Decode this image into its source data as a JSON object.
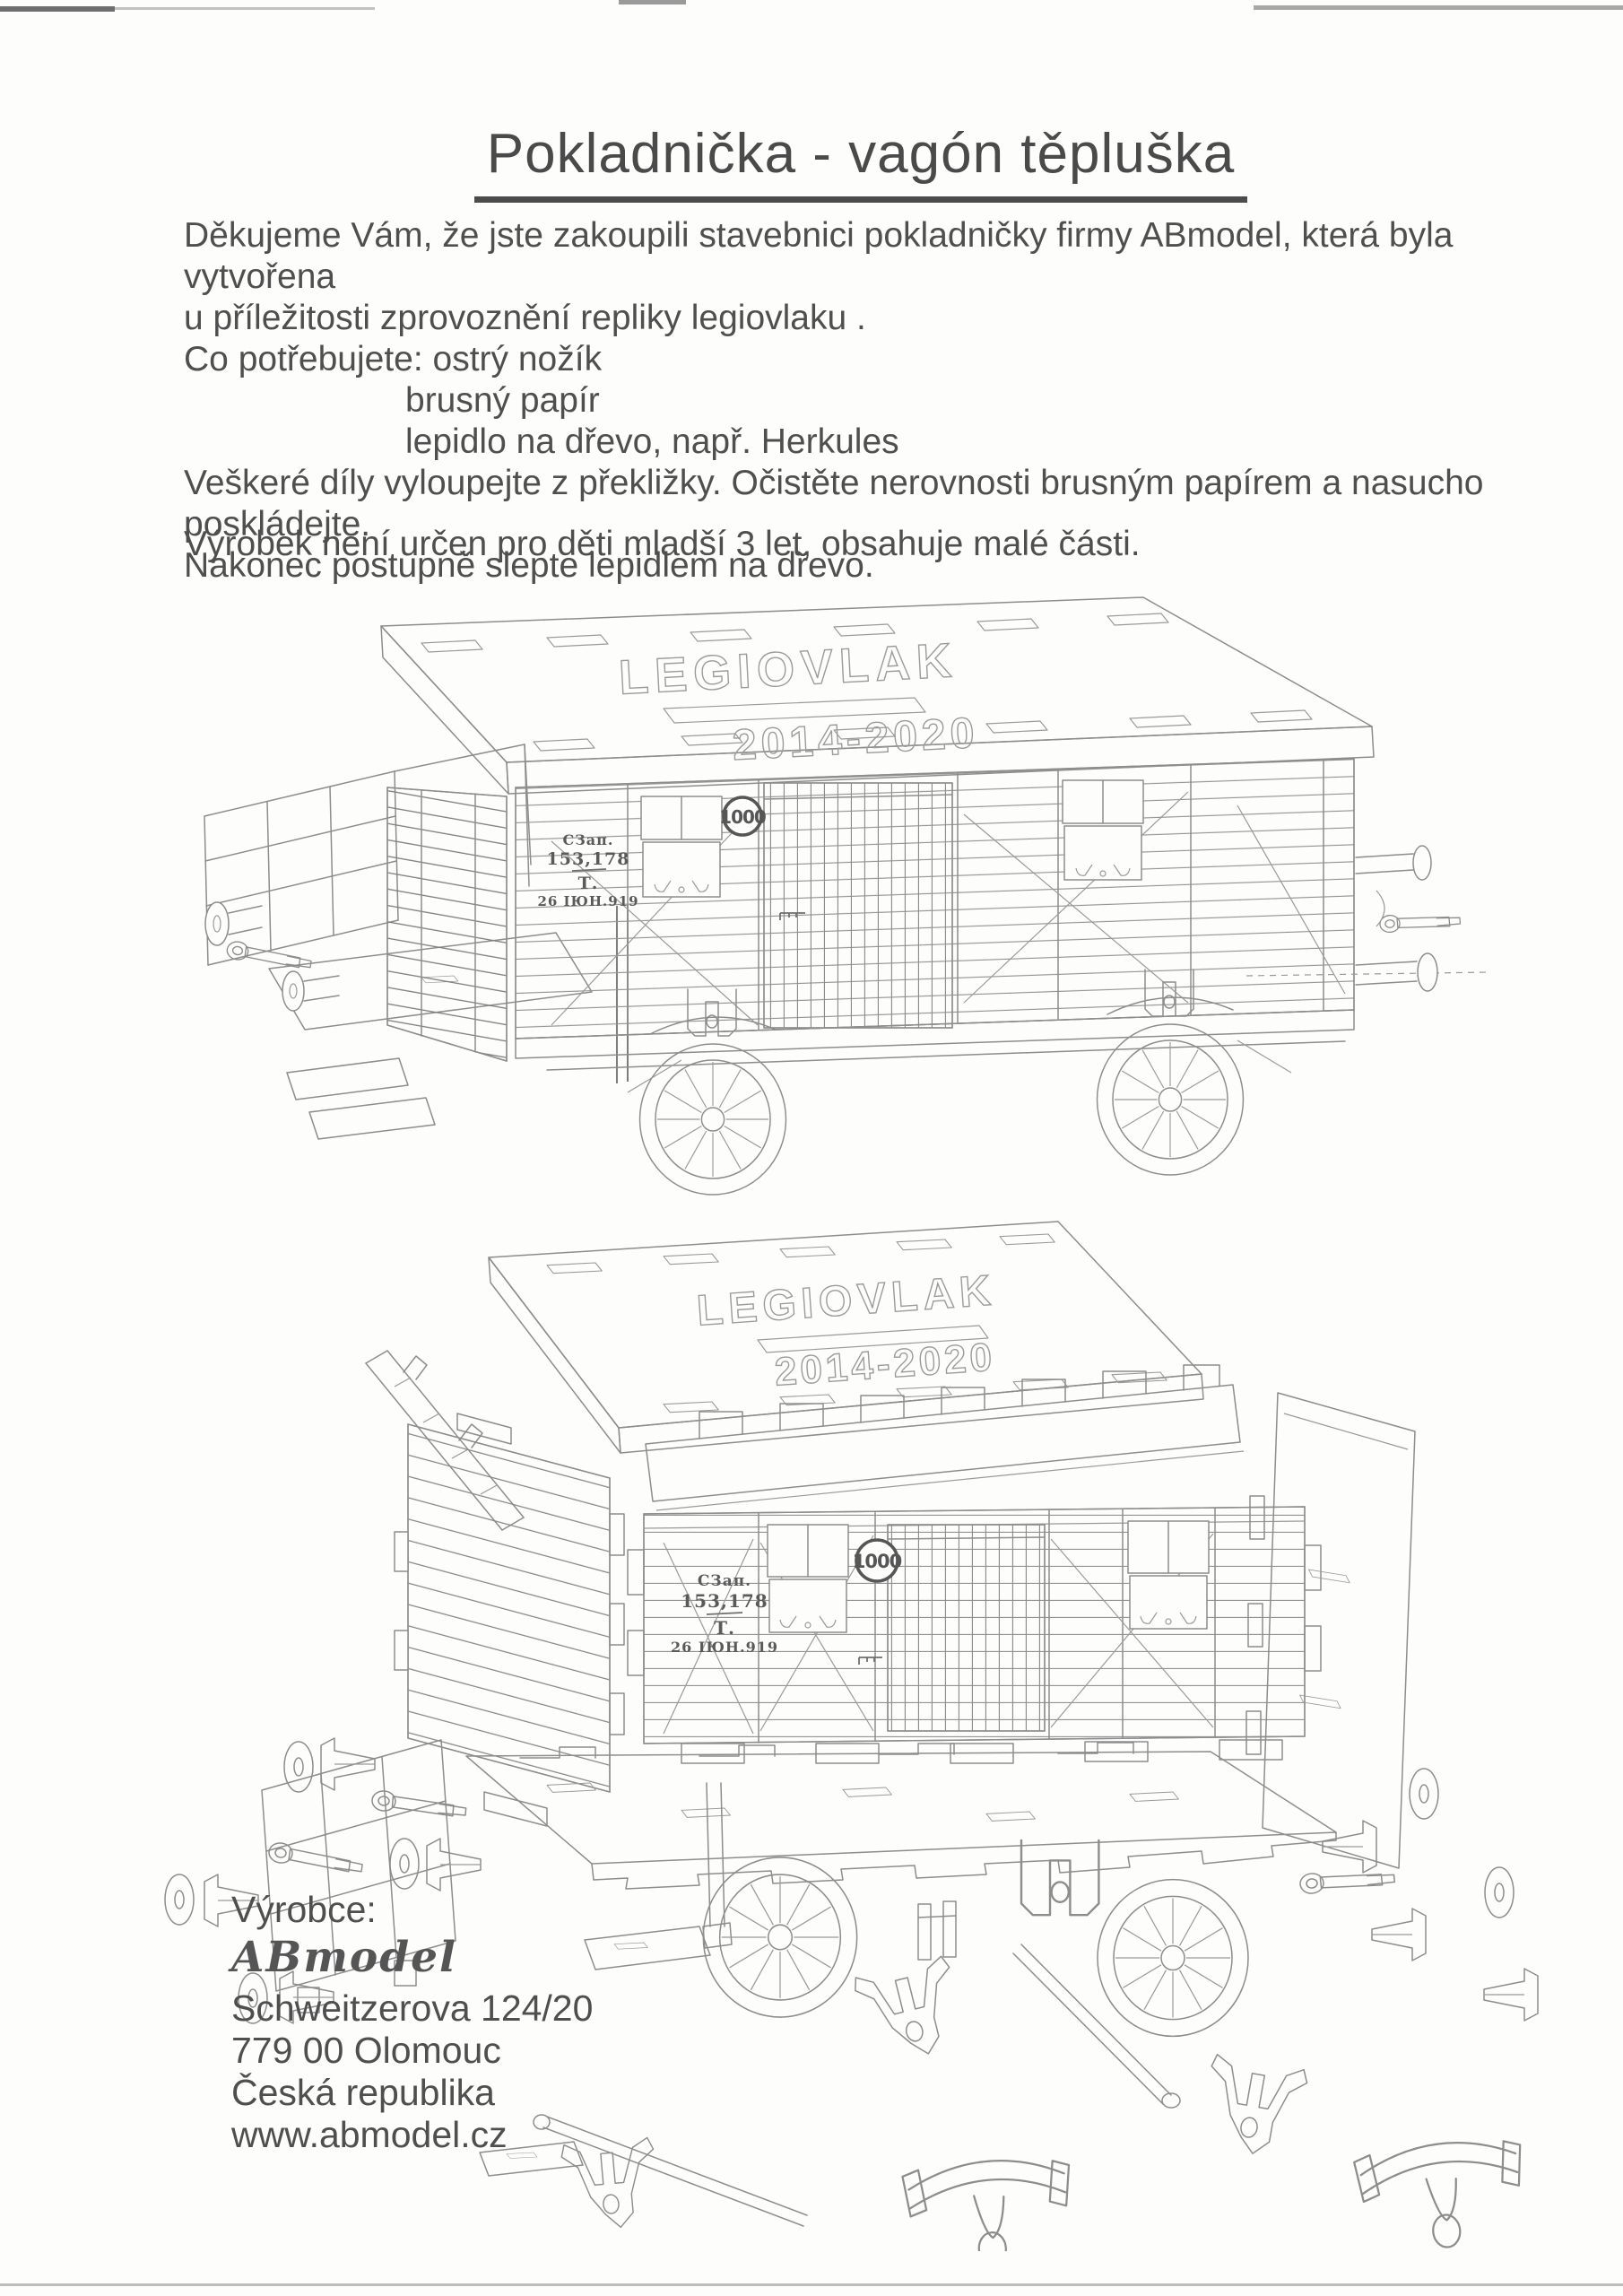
{
  "document": {
    "title": "Pokladnička - vagón těpluška",
    "intro": {
      "line1": "Děkujeme Vám, že jste zakoupili stavebnici pokladničky firmy ABmodel, která byla vytvořena",
      "line2": "u příležitosti zprovoznění repliky legiovlaku .",
      "line3": "Co potřebujete: ostrý nožík",
      "line4": "brusný papír",
      "line5": "lepidlo na dřevo, např. Herkules",
      "line6": "Veškeré díly vyloupejte z překližky. Očistěte nerovnosti brusným papírem a nasucho poskládejte.",
      "line7": "Nakonec postupně slepte lepidlem na dřevo.",
      "warning": "Výrobek není určen pro děti mladší 3 let, obsahuje malé části."
    }
  },
  "wagon_markings": {
    "roof_name": "LEGIOVLAK",
    "roof_years": "2014-2020",
    "load_badge": "1000",
    "side_owner": "СЗап.",
    "side_number": "153,178",
    "side_tare": "Т.",
    "side_date": "26 ІЮН.919"
  },
  "manufacturer": {
    "label": "Výrobce:",
    "brand": "ABmodel",
    "street": "Schweitzerova 124/20",
    "city": "779 00 Olomouc",
    "country": "Česká republika",
    "website": "www.abmodel.cz"
  }
}
